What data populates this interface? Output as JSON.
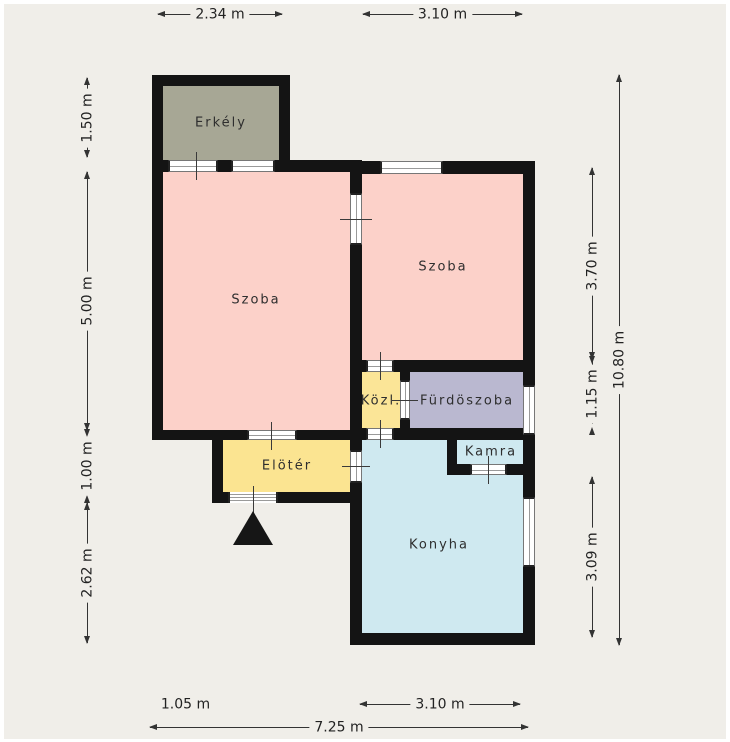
{
  "page": {
    "background": "#f0eee9",
    "frame_color": "#ffffff",
    "wall_color": "#141414"
  },
  "rooms": {
    "erkely": {
      "label": "Erkély",
      "color": "#a7a795"
    },
    "szoba_left": {
      "label": "Szoba",
      "color": "#fcd1c9"
    },
    "szoba_right": {
      "label": "Szoba",
      "color": "#fcd1c9"
    },
    "kozl": {
      "label": "Közl.",
      "color": "#fbe597"
    },
    "furdoszoba": {
      "label": "Fürdöszoba",
      "color": "#bab8d0"
    },
    "eloter": {
      "label": "Elötér",
      "color": "#fbe491"
    },
    "kamra": {
      "label": "Kamra",
      "color": "#c8b28f"
    },
    "konyha": {
      "label": "Konyha",
      "color": "#cfe9f0"
    }
  },
  "dimensions": {
    "top_balcony": "2.34 m",
    "top_room": "3.10 m",
    "left_balcony": "1.50 m",
    "left_room": "5.00 m",
    "left_entry": "1.00 m",
    "left_lower": "2.62 m",
    "right_room": "3.70 m",
    "right_bath": "1.15 m",
    "right_kitchen": "3.09 m",
    "right_total": "10.80 m",
    "bottom_left_offset": "1.05 m",
    "bottom_kitchen": "3.10 m",
    "bottom_total": "7.25 m"
  }
}
